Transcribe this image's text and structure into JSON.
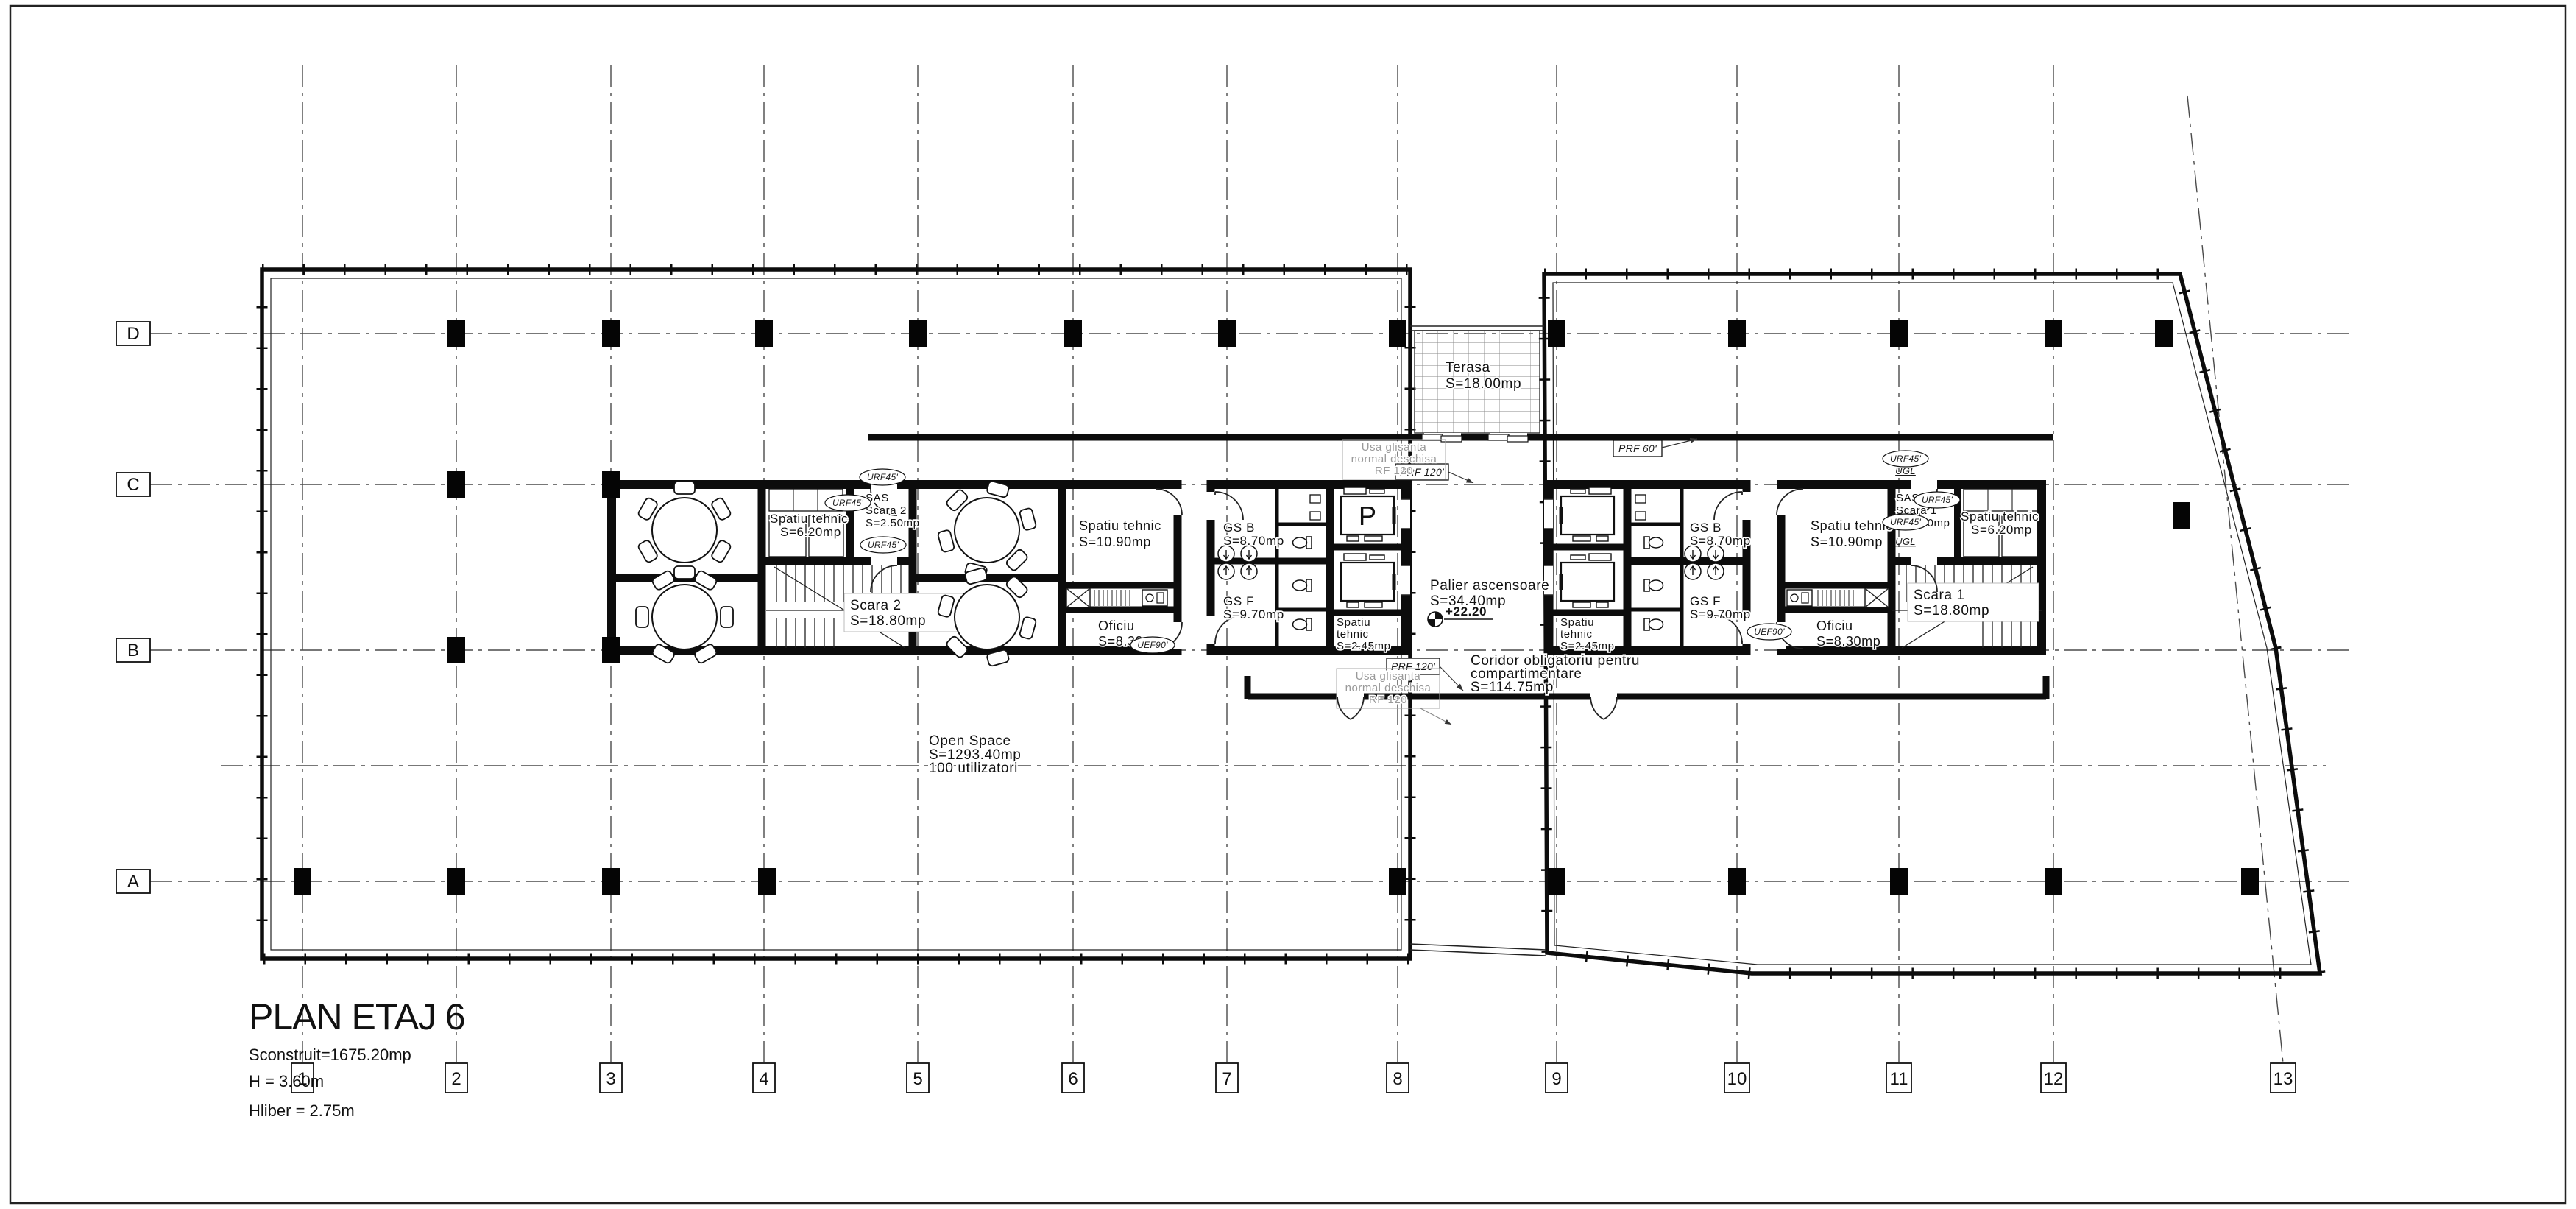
{
  "title_block": {
    "title": "PLAN ETAJ 6",
    "built_area": "Sconstruit=1675.20mp",
    "height": "H = 3.60m",
    "clear_height": "Hliber = 2.75m"
  },
  "grid": {
    "cols": [
      "1",
      "2",
      "3",
      "4",
      "5",
      "6",
      "7",
      "8",
      "9",
      "10",
      "11",
      "12",
      "13"
    ],
    "rows": [
      "D",
      "C",
      "B",
      "A"
    ]
  },
  "rooms": {
    "terasa": {
      "name": "Terasa",
      "area": "S=18.00mp"
    },
    "open_space": {
      "name": "Open Space",
      "area": "S=1293.40mp",
      "capacity": "100 utilizatori"
    },
    "palier": {
      "name": "Palier ascensoare",
      "area": "S=34.40mp"
    },
    "coridor": {
      "l1": "Coridor obligatoriu pentru",
      "l2": "compartimentare",
      "area": "S=114.75mp"
    },
    "spatiu_tehnic_620": {
      "name": "Spatiu tehnic",
      "area": "S=6.20mp"
    },
    "spatiu_tehnic_1090": {
      "name": "Spatiu tehnic",
      "area": "S=10.90mp"
    },
    "spatiu_tehnic_245": {
      "l1": "Spatiu",
      "l2": "tehnic",
      "area": "S=2.45mp"
    },
    "sas_scara_2": {
      "l1": "SAS",
      "l2": "Scara 2",
      "area": "S=2.50mp"
    },
    "sas_scara_1": {
      "l1": "SAS",
      "l2": "Scara 1",
      "area": "S=2.50mp"
    },
    "scara_2": {
      "name": "Scara 2",
      "area": "S=18.80mp"
    },
    "scara_1": {
      "name": "Scara 1",
      "area": "S=18.80mp"
    },
    "gs_b": {
      "name": "GS B",
      "area": "S=8.70mp"
    },
    "gs_f": {
      "name": "GS F",
      "area": "S=9.70mp"
    },
    "oficiu": {
      "name": "Oficiu",
      "area": "S=8.30mp"
    },
    "elevator": {
      "label": "P"
    }
  },
  "tags": {
    "prf120": "PRF 120'",
    "prf60": "PRF 60'",
    "urf45": "URF45'",
    "uef90": "UEF90'",
    "ugl": "UGL"
  },
  "notes": {
    "sliding_door": {
      "l1": "Usa glisanta",
      "l2": "normal deschisa",
      "l3": "RF 120"
    }
  },
  "level_marker": "+22.20"
}
